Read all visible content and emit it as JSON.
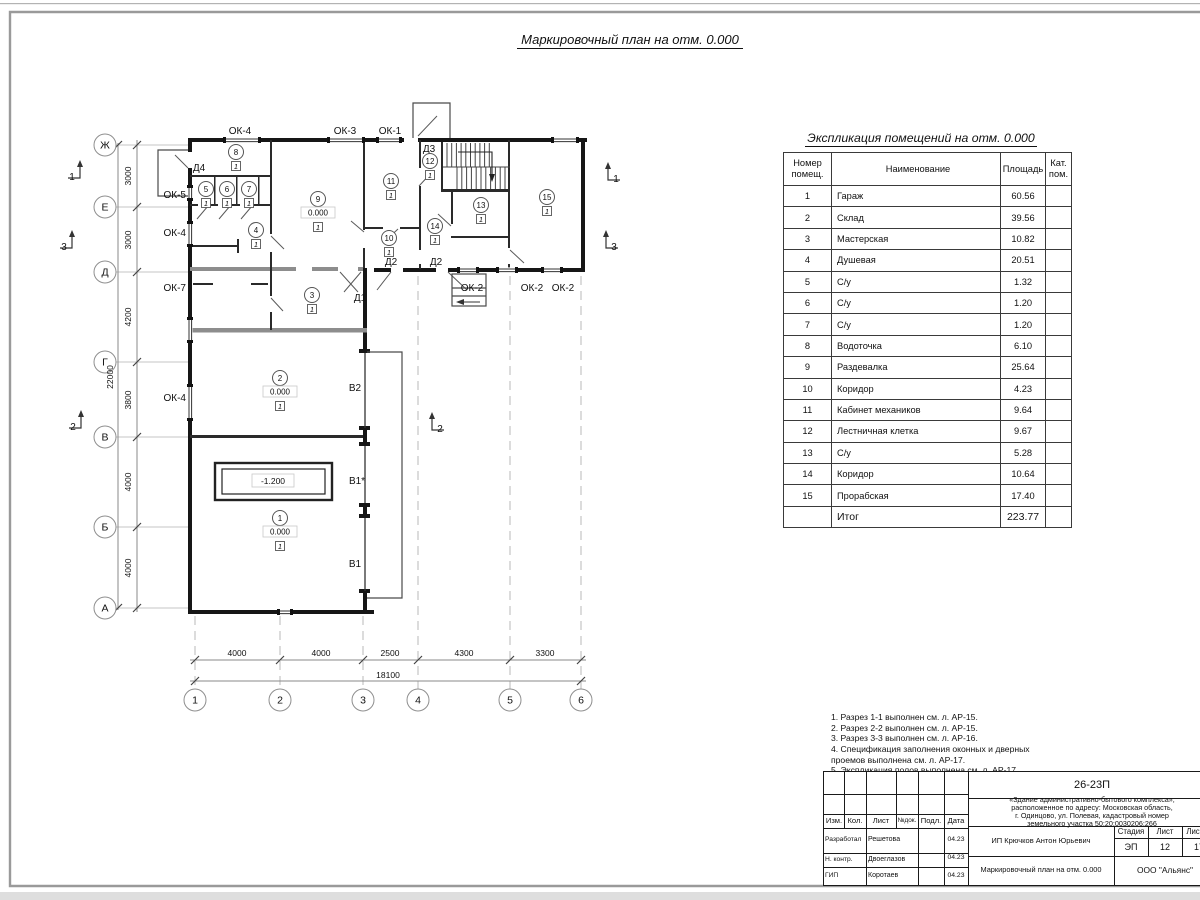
{
  "sheet": {
    "main_title": "Маркировочный план на отм. 0.000",
    "expl_title": "Экспликация помещений на отм. 0.000",
    "notes": "1. Разрез 1-1 выполнен см. л. АР-15.\n2. Разрез 2-2 выполнен см. л. АР-15.\n3. Разрез 3-3 выполнен см. л. АР-16.\n4. Спецификация заполнения оконных и дверных\n    проемов выполнена см. л. АР-17.\n5. Экспликация полов выполнена см. л. АР-17."
  },
  "expl_table": {
    "headers": {
      "num": "Номер\nпомещ.",
      "name": "Наименование",
      "area": "Площадь",
      "cat": "Кат.\nпом."
    },
    "rows": [
      {
        "num": "1",
        "name": "Гараж",
        "area": "60.56"
      },
      {
        "num": "2",
        "name": "Склад",
        "area": "39.56"
      },
      {
        "num": "3",
        "name": "Мастерская",
        "area": "10.82"
      },
      {
        "num": "4",
        "name": "Душевая",
        "area": "20.51"
      },
      {
        "num": "5",
        "name": "С/у",
        "area": "1.32"
      },
      {
        "num": "6",
        "name": "С/у",
        "area": "1.20"
      },
      {
        "num": "7",
        "name": "С/у",
        "area": "1.20"
      },
      {
        "num": "8",
        "name": "Водоточка",
        "area": "6.10"
      },
      {
        "num": "9",
        "name": "Раздевалка",
        "area": "25.64"
      },
      {
        "num": "10",
        "name": "Коридор",
        "area": "4.23"
      },
      {
        "num": "11",
        "name": "Кабинет механиков",
        "area": "9.64"
      },
      {
        "num": "12",
        "name": "Лестничная клетка",
        "area": "9.67"
      },
      {
        "num": "13",
        "name": "С/у",
        "area": "5.28"
      },
      {
        "num": "14",
        "name": "Коридор",
        "area": "10.64"
      },
      {
        "num": "15",
        "name": "Прорабская",
        "area": "17.40"
      },
      {
        "num": "",
        "name": "Итог",
        "area": "223.77",
        "total": true
      }
    ]
  },
  "plan": {
    "axis_rows": [
      {
        "label": "Ж",
        "y": 145
      },
      {
        "label": "Е",
        "y": 207
      },
      {
        "label": "Д",
        "y": 272
      },
      {
        "label": "Г",
        "y": 362
      },
      {
        "label": "В",
        "y": 437
      },
      {
        "label": "Б",
        "y": 527
      },
      {
        "label": "А",
        "y": 608
      }
    ],
    "axis_cols": [
      {
        "label": "1",
        "x": 195
      },
      {
        "label": "2",
        "x": 280
      },
      {
        "label": "3",
        "x": 363
      },
      {
        "label": "4",
        "x": 418
      },
      {
        "label": "5",
        "x": 510
      },
      {
        "label": "6",
        "x": 581
      }
    ],
    "dims_left": [
      {
        "v": "3000",
        "y": 176
      },
      {
        "v": "3000",
        "y": 240
      },
      {
        "v": "4200",
        "y": 317
      },
      {
        "v": "3800",
        "y": 400
      },
      {
        "v": "4000",
        "y": 482
      },
      {
        "v": "4000",
        "y": 568
      },
      {
        "v": "22000",
        "y": 377,
        "x": 113
      }
    ],
    "dims_bottom": [
      {
        "v": "4000",
        "x": 237
      },
      {
        "v": "4000",
        "x": 321
      },
      {
        "v": "2500",
        "x": 390
      },
      {
        "v": "4300",
        "x": 464
      },
      {
        "v": "3300",
        "x": 545
      },
      {
        "v": "18100",
        "x": 388,
        "y": 678
      }
    ],
    "openings": [
      {
        "t": "ОК-4",
        "x": 240,
        "y": 134
      },
      {
        "t": "ОК-3",
        "x": 345,
        "y": 134
      },
      {
        "t": "ОК-1",
        "x": 390,
        "y": 134
      },
      {
        "t": "Д3",
        "x": 429,
        "y": 152
      },
      {
        "t": "Д4",
        "x": 199,
        "y": 171
      },
      {
        "t": "ОК-5",
        "x": 186,
        "y": 198,
        "a": "end"
      },
      {
        "t": "ОК-4",
        "x": 186,
        "y": 236,
        "a": "end"
      },
      {
        "t": "ОК-7",
        "x": 186,
        "y": 291,
        "a": "end"
      },
      {
        "t": "ОК-4",
        "x": 186,
        "y": 401,
        "a": "end"
      },
      {
        "t": "Д2",
        "x": 391,
        "y": 265
      },
      {
        "t": "Д2",
        "x": 436,
        "y": 265
      },
      {
        "t": "Д1",
        "x": 360,
        "y": 301
      },
      {
        "t": "ОК-2",
        "x": 472,
        "y": 291
      },
      {
        "t": "ОК-2",
        "x": 532,
        "y": 291
      },
      {
        "t": "ОК-2",
        "x": 563,
        "y": 291
      },
      {
        "t": "В2",
        "x": 355,
        "y": 391
      },
      {
        "t": "В1*",
        "x": 357,
        "y": 484
      },
      {
        "t": "В1",
        "x": 355,
        "y": 567
      }
    ],
    "rooms": [
      {
        "n": "1",
        "x": 280,
        "y": 518,
        "level": "0.000"
      },
      {
        "n": "2",
        "x": 280,
        "y": 378,
        "level": "0.000"
      },
      {
        "n": "3",
        "x": 312,
        "y": 295
      },
      {
        "n": "4",
        "x": 256,
        "y": 230
      },
      {
        "n": "5",
        "x": 206,
        "y": 189
      },
      {
        "n": "6",
        "x": 227,
        "y": 189
      },
      {
        "n": "7",
        "x": 249,
        "y": 189
      },
      {
        "n": "8",
        "x": 236,
        "y": 152
      },
      {
        "n": "9",
        "x": 318,
        "y": 199,
        "level": "0.000"
      },
      {
        "n": "10",
        "x": 389,
        "y": 238
      },
      {
        "n": "11",
        "x": 391,
        "y": 181
      },
      {
        "n": "12",
        "x": 430,
        "y": 161
      },
      {
        "n": "13",
        "x": 481,
        "y": 205
      },
      {
        "n": "14",
        "x": 435,
        "y": 226
      },
      {
        "n": "15",
        "x": 547,
        "y": 197
      }
    ],
    "floor_mark": "1",
    "pit": {
      "v": "-1.200",
      "x": 273,
      "y": 481
    },
    "sections": [
      {
        "n": "1",
        "x": 72,
        "y": 180,
        "side": "l"
      },
      {
        "n": "3",
        "x": 64,
        "y": 250,
        "side": "l"
      },
      {
        "n": "2",
        "x": 73,
        "y": 430,
        "side": "l"
      },
      {
        "n": "1",
        "x": 616,
        "y": 182,
        "side": "r"
      },
      {
        "n": "3",
        "x": 614,
        "y": 250,
        "side": "r"
      },
      {
        "n": "2",
        "x": 440,
        "y": 432,
        "side": "r"
      }
    ]
  },
  "stamp": {
    "doc_code": "26-23П",
    "description": "«Здание административно-бытового комплекса»,\nрасположенное по адресу: Московская область,\nг. Одинцово, ул. Полевая, кадастровый номер\nземельного участка 50:20:0030206:266",
    "col_izm": "Изм.",
    "col_kol": "Кол.",
    "col_list": "Лист",
    "col_ndoc": "№док.",
    "col_podl": "Подл.",
    "col_data": "Дата",
    "rows": [
      {
        "role": "Разработал",
        "name": "Решетова",
        "date": "04.23"
      },
      {
        "role": "Н. контр.",
        "name": "Двоеглазов",
        "date": "04.23"
      },
      {
        "role": "ГИП",
        "name": "Коротаев",
        "date": "04.23"
      }
    ],
    "client": "ИП Крючков Антон Юрьевич",
    "stage_label": "Стадия",
    "sheet_label": "Лист",
    "sheets_label": "Листов",
    "stage": "ЭП",
    "sheet_num": "12",
    "sheets_total": "17",
    "title": "Маркировочный план на отм. 0.000",
    "org": "ООО \"Альянс\""
  }
}
